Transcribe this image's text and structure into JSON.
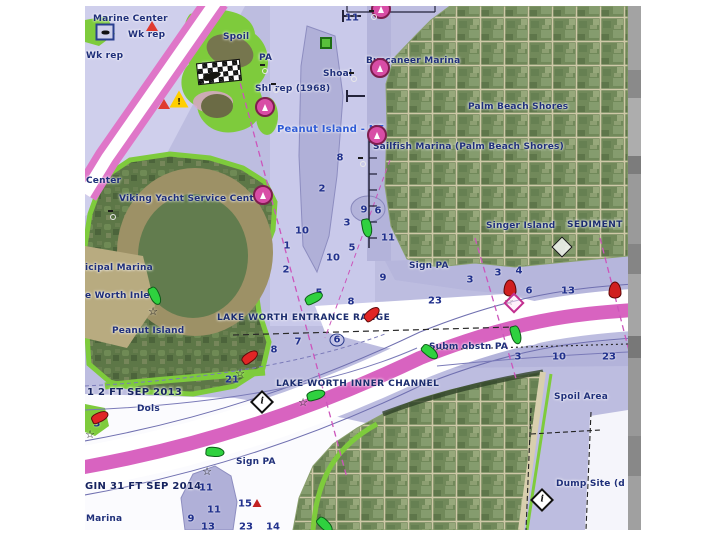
{
  "map": {
    "place_labels": {
      "marine_center": "Marine Center",
      "wk_rep_a": "Wk rep",
      "wk_rep_b": "Wk rep",
      "spoil": "Spoil",
      "wks": "Wks",
      "pa": "PA",
      "shoal": "Shoal",
      "shl_rep": "Shl rep (1968)",
      "buccaneer_marina": "Buccaneer Marina",
      "palm_beach_shores": "Palm Beach Shores",
      "peanut_island_ne": "Peanut Island - NE",
      "sailfish_marina": "Sailfish Marina (Palm Beach Shores)",
      "singer_island": "Singer Island",
      "sediment": "SEDIMENT",
      "viking_yacht": "Viking Yacht Service Center",
      "center_fragment": "Center",
      "municipal_marina_fragment": "icipal Marina",
      "worth_inlet_fragment": "e Worth Inlet",
      "peanut_island": "Peanut Island",
      "entrance_range": "LAKE WORTH ENTRANCE RANGE",
      "inner_channel": "LAKE WORTH INNER CHANNEL",
      "note_sep_2013": "1 2 FT SEP 2013",
      "dols": "Dols",
      "note_sep_2014": "GIN 31 FT SEP 2014",
      "marina_fragment": "Marina",
      "sign_pa_north": "Sign PA",
      "subm_obstn_pa": "Subm obstn PA",
      "sign_pa_south": "Sign PA",
      "spoil_area": "Spoil Area",
      "dump_site_fragment": "Dump Site (d"
    },
    "depth_soundings": [
      "11",
      "8",
      "2",
      "1",
      "2",
      "9",
      "6",
      "3",
      "10",
      "11",
      "5",
      "10",
      "9",
      "7",
      "8",
      "9",
      "21",
      "5",
      "8",
      "6",
      "3",
      "3",
      "4",
      "6",
      "13",
      "23",
      "3",
      "10",
      "23",
      "3",
      "11",
      "11",
      "9",
      "13",
      "15",
      "23",
      "14"
    ],
    "glyphs": {
      "info": "i",
      "warning": "!"
    },
    "colors": {
      "water": "#bdbde0",
      "water_shallow": "#b0b0d8",
      "water_deep": "#ffffff",
      "shoal_green": "#7ecb3c",
      "channel_magenta": "#d863c0",
      "label_navy": "#1f2f7a",
      "label_blue": "#2f5bd6",
      "marina_pink": "#d84da6",
      "buoy_green": "#2fd13f",
      "buoy_red": "#e02525"
    }
  }
}
